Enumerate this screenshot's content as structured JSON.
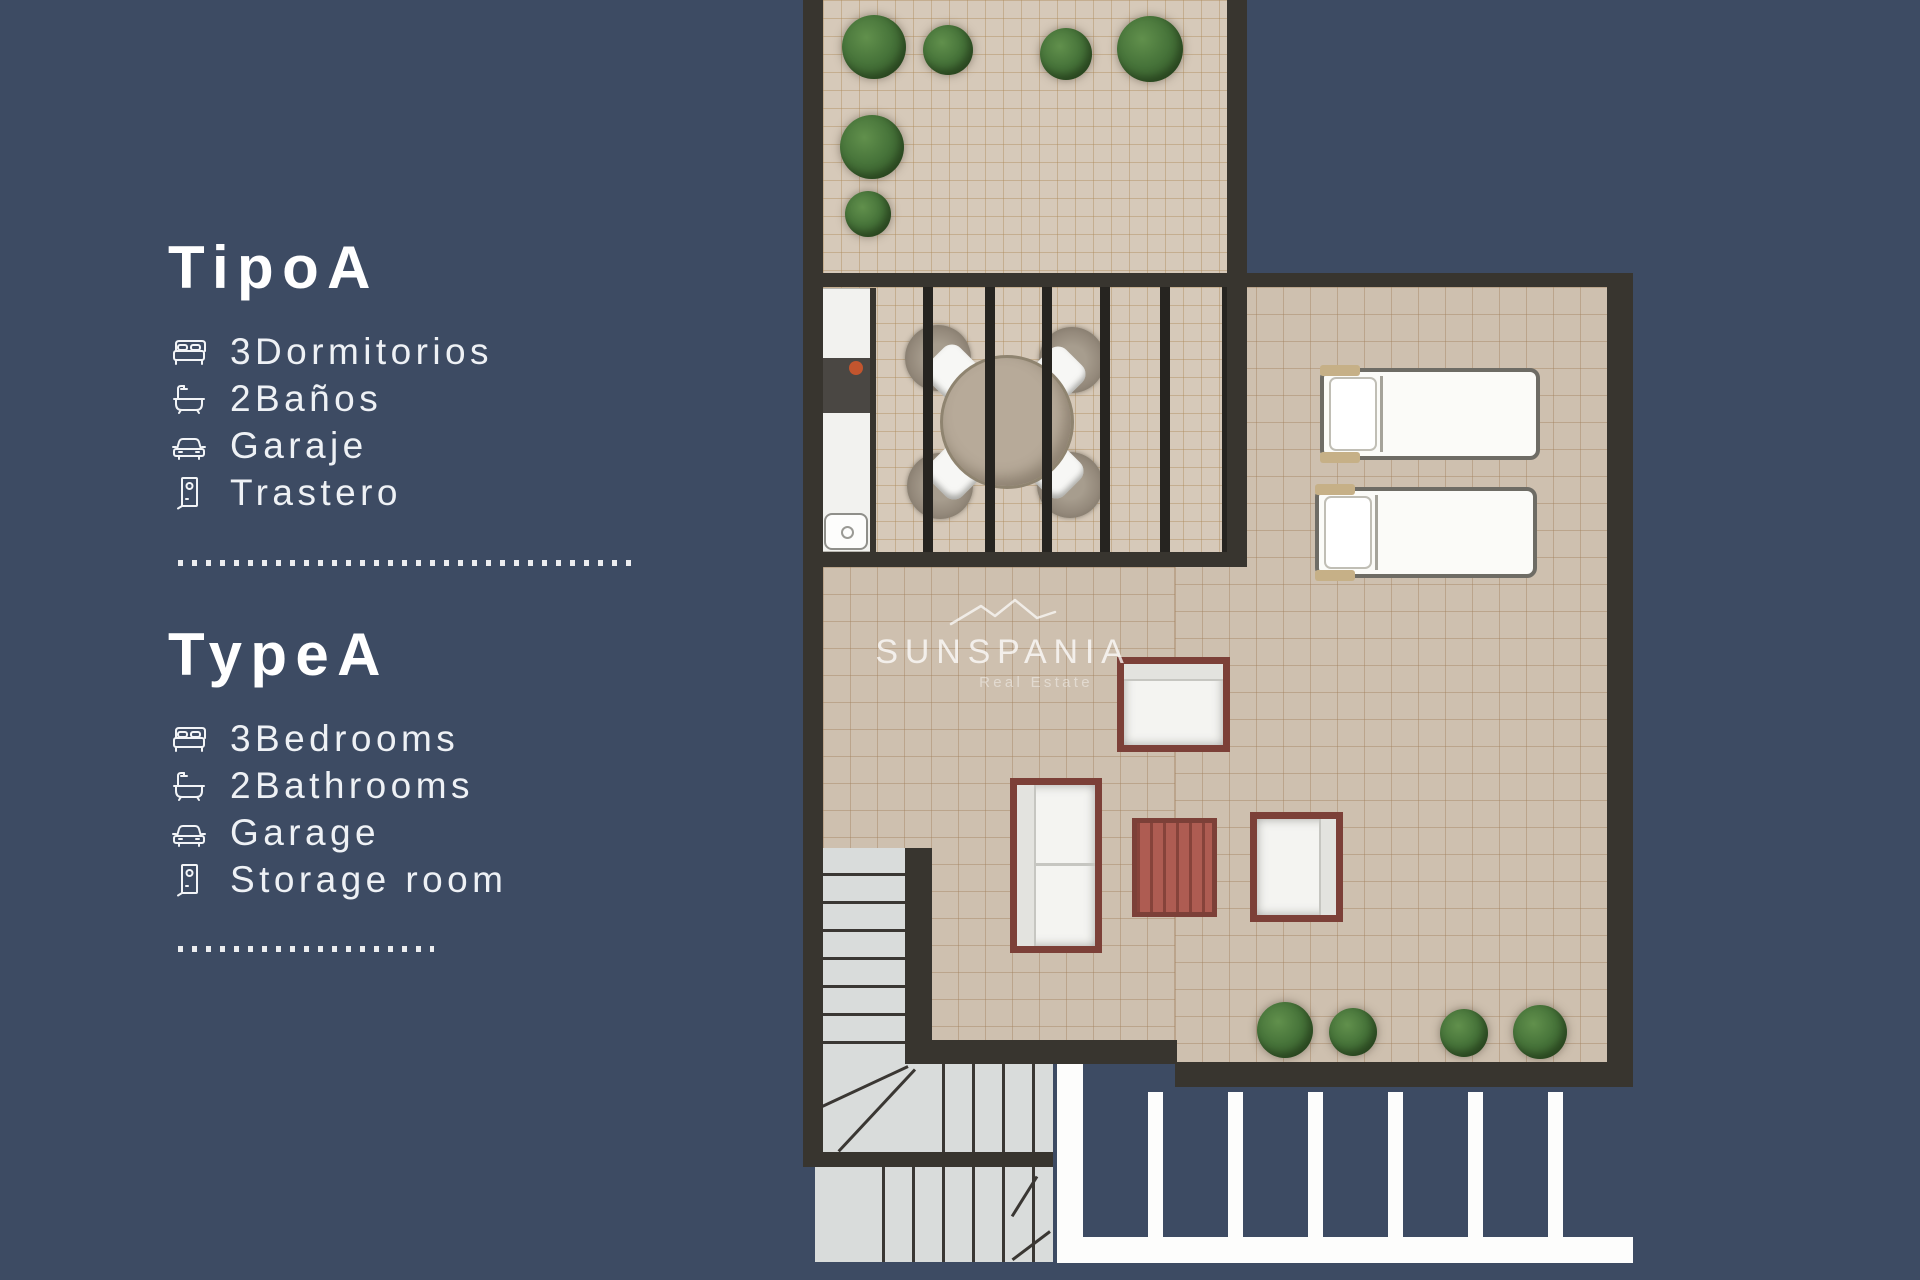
{
  "colors": {
    "bg": "#3d4b63",
    "wall": "#38352f",
    "text": "#eef1f5",
    "terrace_floor": "#d6c9b9",
    "terrace_grid": "rgba(173,136,88,0.42)",
    "living_floor": "#cec0af",
    "living_grid": "rgba(160,128,90,0.42)",
    "stair_fill": "#d9dcdb",
    "stair_line": "#3a3733",
    "plant": "#47743a",
    "plant_dark": "#2f5226",
    "frame_red": "#7c4038",
    "table_red": "#ae5c52",
    "cushion": "#f4f4f1",
    "dining_table": "#b7aa99",
    "wicker": "#94897b",
    "counter_dark": "#4a4743",
    "burner_orange": "#c2552e",
    "lounger_accent": "#c6b087",
    "white_strip": "#fdfdfc"
  },
  "info_panel": {
    "sections": [
      {
        "title": "TipoA",
        "items": [
          {
            "icon": "bed-icon",
            "label": "3Dormitorios"
          },
          {
            "icon": "bathtub-icon",
            "label": "2Baños"
          },
          {
            "icon": "car-icon",
            "label": "Garaje"
          },
          {
            "icon": "door-icon",
            "label": "Trastero"
          }
        ]
      },
      {
        "title": "TypeA",
        "items": [
          {
            "icon": "bed-icon",
            "label": "3Bedrooms"
          },
          {
            "icon": "bathtub-icon",
            "label": "2Bathrooms"
          },
          {
            "icon": "car-icon",
            "label": "Garage"
          },
          {
            "icon": "door-icon",
            "label": "Storage room"
          }
        ]
      }
    ]
  },
  "watermark": {
    "brand": "SUNSPANIA",
    "tagline": "Real Estate"
  }
}
